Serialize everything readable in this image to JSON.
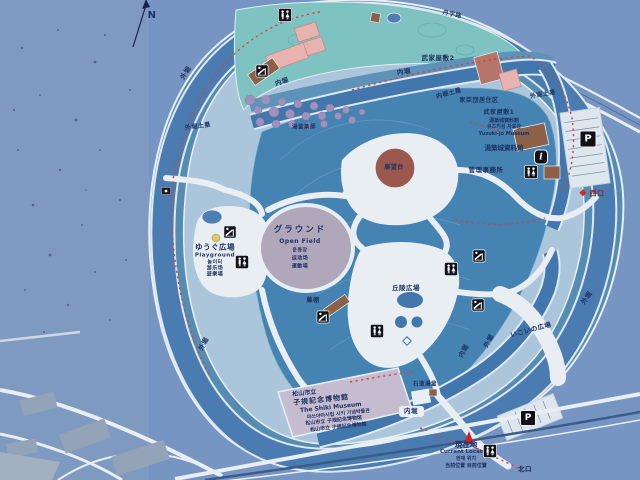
{
  "map": {
    "compass": {
      "n": "N"
    },
    "road_label": "丹字路",
    "labels": {
      "outer_moat": "外堀",
      "inner_moat": "内堀",
      "outer_moat_bank": "外堀土塁",
      "inner_moat_bank": "内堀土塁",
      "samurai_residence_2": "武家屋敷2",
      "samurai_residence_1": "武家屋敷1",
      "vassals_quarter": "家臣団居住区",
      "yugama_yakushi": "湯釜薬師",
      "observation_deck": "展望台",
      "hill_plaza": "丘陵広場",
      "wisteria_trellis": "藤棚",
      "ikoi_plaza": "いこいの広場",
      "stone_yugama": "石造湯釜",
      "admin_office": "管理事務所",
      "west_exit": "西口",
      "north_exit": "北口"
    },
    "open_field": {
      "ja": "グラウンド",
      "en": "Open Field",
      "ko": "운동장",
      "zh_cn": "运动场",
      "zh_tw": "運動場"
    },
    "playground": {
      "ja": "ゆうぐ広場",
      "en": "Playground",
      "ko": "놀이터",
      "zh_cn": "游乐场",
      "zh_tw": "遊樂場"
    },
    "yuzuki_museum": {
      "ja": "湯築城資料館",
      "ko": "유즈키성 자료관",
      "en": "Yuzuki-jo Museum",
      "ja2": "湯築城資料館"
    },
    "shiki_museum": {
      "ja1": "松山市立",
      "ja2": "子規記念博物館",
      "en": "The Shiki Museum",
      "ko": "마쓰야마시립 시키 기념박물관",
      "zh_cn": "松山市立 子规纪念博物馆",
      "zh_tw": "松山市立 子規記念博物館"
    },
    "current_location": {
      "ja": "現在地",
      "en": "Current Location",
      "ko": "현재 위치",
      "zh": "当前位置 目前位置"
    },
    "icons": {
      "parking": "P",
      "info": "i"
    },
    "colors": {
      "sign_bg": "#7795c3",
      "moat": "#4a7cb2",
      "hill": "#4583b2",
      "residence_zone": "#7fc2c2",
      "field": "#b1a7bb",
      "museum_slab": "#c5bcd0",
      "building_pink": "#e8b2ae",
      "building_brown": "#8d6148",
      "route_red": "#d24444",
      "label_navy": "#1e3263",
      "location_red": "#d01f1f"
    }
  }
}
